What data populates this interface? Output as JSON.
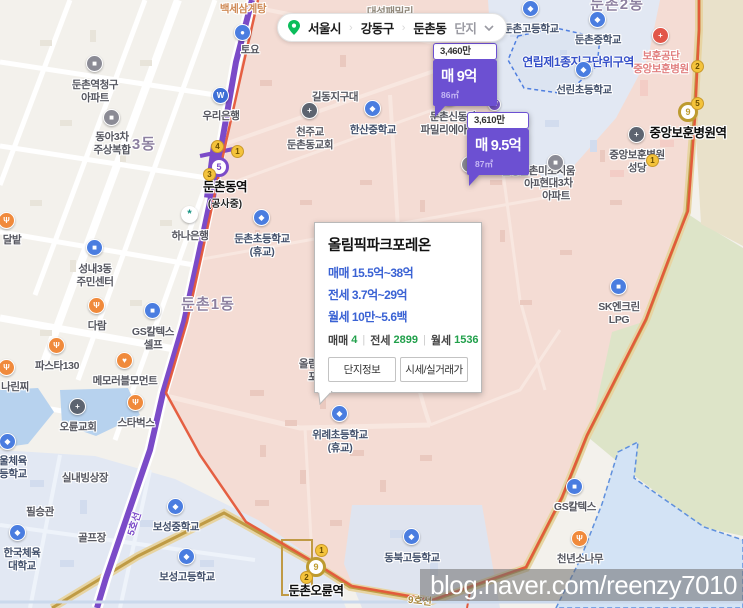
{
  "filter_bar": {
    "region_labels": [
      "서울시",
      "강동구",
      "둔촌동"
    ],
    "dropdown_label": "단지",
    "separator": "›",
    "pin_color": "#0bbd5b"
  },
  "markers": [
    {
      "sub_price": "3,460만",
      "price": "매 9억",
      "area": "86㎡"
    },
    {
      "sub_price": "3,610만",
      "price": "매 9.5억",
      "area": "87㎡"
    }
  ],
  "complex_card": {
    "title": "올림픽파크포레온",
    "sale": "매매 15.5억~38억",
    "jeonse": "전세 3.7억~29억",
    "wolse": "월세 10만~5.6백",
    "counts": [
      {
        "label": "매매",
        "value": "4"
      },
      {
        "label": "전세",
        "value": "2899"
      },
      {
        "label": "월세",
        "value": "1536"
      }
    ],
    "counts_sep": "|",
    "buttons": [
      "단지정보",
      "시세/실거래가"
    ]
  },
  "watermark": "blog.naver.com/reenzy7010",
  "colors": {
    "marker_purple": "#6c50d2",
    "line5_purple": "#7b4bc8",
    "line9_gold": "#bf9b45",
    "boundary_red": "#e4573a",
    "price_blue": "#3a62d4",
    "count_green": "#21a04b"
  },
  "map": {
    "districts": [
      {
        "label": "둔촌1동",
        "x": 208,
        "y": 293
      },
      {
        "label": "3동",
        "x": 144,
        "y": 133
      },
      {
        "label": "둔촌2동",
        "x": 617,
        "y": -7
      }
    ],
    "zone_label": {
      "label": "연립제1종지구단위구역",
      "x": 578,
      "y": 53
    },
    "line_labels": [
      {
        "label": "5호선",
        "x": 121,
        "y": 516,
        "rot": -72,
        "color": "#7b4bc8"
      },
      {
        "label": "9호선",
        "x": 408,
        "y": 592,
        "rot": 6,
        "color": "#a8863a"
      }
    ],
    "stations": [
      {
        "name": "둔촌동역",
        "sub": "(공사중)",
        "x": 225,
        "y": 176,
        "badge": "5",
        "badge_color": "#7b4bc8",
        "bx": 219,
        "by": 167,
        "exits": [
          {
            "n": "4",
            "x": 217,
            "y": 146
          },
          {
            "n": "1",
            "x": 237,
            "y": 151
          },
          {
            "n": "3",
            "x": 209,
            "y": 174
          }
        ]
      },
      {
        "name": "둔촌오륜역",
        "sub": "",
        "x": 316,
        "y": 580,
        "badge": "9",
        "badge_color": "#bd9b30",
        "bx": 316,
        "by": 567,
        "exits": [
          {
            "n": "1",
            "x": 321,
            "y": 550
          },
          {
            "n": "2",
            "x": 306,
            "y": 577
          }
        ]
      },
      {
        "name": "중앙보훈병원역",
        "sub": "",
        "x": 688,
        "y": 122,
        "badge": "9",
        "badge_color": "#bd9b30",
        "bx": 688,
        "by": 112,
        "exits": [
          {
            "n": "2",
            "x": 697,
            "y": 66
          },
          {
            "n": "5",
            "x": 697,
            "y": 103
          },
          {
            "n": "1",
            "x": 652,
            "y": 160
          }
        ]
      }
    ],
    "pois": [
      {
        "lines": [
          "백세삼계탕"
        ],
        "x": 243,
        "y": 3,
        "cls": "orange-text"
      },
      {
        "lines": [
          "대성패밀리"
        ],
        "x": 390,
        "y": 6,
        "cls": "brown"
      },
      {
        "lines": [
          "토요"
        ],
        "x": 250,
        "y": 44,
        "icon": "store",
        "icx": 243,
        "icy": 33
      },
      {
        "lines": [
          "둔촌역청구",
          "아파트"
        ],
        "x": 95,
        "y": 79,
        "icon": "building",
        "icx": 95,
        "icy": 64
      },
      {
        "lines": [
          "우리은행"
        ],
        "x": 221,
        "y": 110,
        "icon": "bank-woori",
        "icx": 221,
        "icy": 96
      },
      {
        "lines": [
          "동아3차",
          "주상복합"
        ],
        "x": 112,
        "y": 131,
        "icon": "building",
        "icx": 112,
        "icy": 118
      },
      {
        "lines": [
          "하나은행"
        ],
        "x": 190,
        "y": 230,
        "icon": "bank-hana",
        "icx": 190,
        "icy": 215
      },
      {
        "lines": [
          "성내3동",
          "주민센터"
        ],
        "x": 95,
        "y": 263,
        "icon": "office",
        "icx": 95,
        "icy": 248
      },
      {
        "lines": [
          "다람"
        ],
        "x": 97,
        "y": 320,
        "icon": "food",
        "icx": 97,
        "icy": 306
      },
      {
        "lines": [
          "GS칼텍스",
          "셀프"
        ],
        "x": 153,
        "y": 326,
        "icon": "gas",
        "icx": 153,
        "icy": 311
      },
      {
        "lines": [
          "파스타130"
        ],
        "x": 57,
        "y": 360,
        "icon": "food",
        "icx": 57,
        "icy": 346
      },
      {
        "lines": [
          "메모러블모먼트"
        ],
        "x": 125,
        "y": 375,
        "icon": "heart",
        "icx": 125,
        "icy": 361
      },
      {
        "lines": [
          "달밭"
        ],
        "x": 12,
        "y": 234,
        "icon": "food",
        "icx": 7,
        "icy": 221
      },
      {
        "lines": [
          "나린찌"
        ],
        "x": 15,
        "y": 381,
        "icon": "food",
        "icx": 7,
        "icy": 368
      },
      {
        "lines": [
          "오륜교회"
        ],
        "x": 78,
        "y": 421,
        "icon": "church",
        "icx": 78,
        "icy": 407
      },
      {
        "lines": [
          "스타벅스"
        ],
        "x": 136,
        "y": 417,
        "icon": "cafe",
        "icx": 136,
        "icy": 403
      },
      {
        "lines": [
          "울체육",
          "등학교"
        ],
        "x": 13,
        "y": 455,
        "icon": "school",
        "icx": 8,
        "icy": 442,
        "cls": "navy"
      },
      {
        "lines": [
          "실내빙상장"
        ],
        "x": 85,
        "y": 472
      },
      {
        "lines": [
          "필승관"
        ],
        "x": 40,
        "y": 506
      },
      {
        "lines": [
          "골프장"
        ],
        "x": 92,
        "y": 532
      },
      {
        "lines": [
          "한국체육",
          "대학교"
        ],
        "x": 22,
        "y": 547,
        "icon": "school",
        "icx": 18,
        "icy": 533,
        "cls": "navy"
      },
      {
        "lines": [
          "보성중학교"
        ],
        "x": 176,
        "y": 521,
        "icon": "school",
        "icx": 176,
        "icy": 507,
        "cls": "navy"
      },
      {
        "lines": [
          "보성고등학교"
        ],
        "x": 187,
        "y": 571,
        "icon": "school",
        "icx": 187,
        "icy": 557,
        "cls": "navy"
      },
      {
        "lines": [
          "동북고등학교"
        ],
        "x": 412,
        "y": 552,
        "icon": "school",
        "icx": 412,
        "icy": 537,
        "cls": "navy"
      },
      {
        "lines": [
          "천주교",
          "둔촌동교회"
        ],
        "x": 310,
        "y": 126,
        "icon": "church",
        "icx": 310,
        "icy": 111
      },
      {
        "lines": [
          "한산중학교"
        ],
        "x": 373,
        "y": 124,
        "icon": "school",
        "icx": 373,
        "icy": 109,
        "cls": "navy"
      },
      {
        "lines": [
          "길동지구대"
        ],
        "x": 335,
        "y": 91
      },
      {
        "lines": [
          "둔촌신동아",
          "파밀리에아파트"
        ],
        "x": 453,
        "y": 111,
        "icon": "building",
        "icx": 450,
        "icy": 98
      },
      {
        "lines": [],
        "icon": "building",
        "icx": 470,
        "icy": 165
      },
      {
        "lines": [
          "신성둔촌미소지움",
          "아파트"
        ],
        "x": 538,
        "y": 165
      },
      {
        "lines": [
          "현대3차",
          "아파트"
        ],
        "x": 556,
        "y": 177,
        "icon": "building",
        "icx": 556,
        "icy": 163
      },
      {
        "lines": [
          "둔촌고등학교"
        ],
        "x": 531,
        "y": 23,
        "icon": "school",
        "icx": 531,
        "icy": 9,
        "cls": "navy"
      },
      {
        "lines": [
          "둔촌중학교"
        ],
        "x": 598,
        "y": 34,
        "icon": "school",
        "icx": 598,
        "icy": 20,
        "cls": "navy"
      },
      {
        "lines": [
          "선린초등학교"
        ],
        "x": 584,
        "y": 84,
        "icon": "school",
        "icx": 584,
        "icy": 70,
        "cls": "navy"
      },
      {
        "lines": [
          "보훈공단",
          "중앙보훈병원"
        ],
        "x": 661,
        "y": 50,
        "icon": "hospital",
        "icx": 661,
        "icy": 36,
        "cls": "red-text"
      },
      {
        "lines": [
          "중앙보훈병원",
          "성당"
        ],
        "x": 637,
        "y": 149,
        "icon": "church",
        "icx": 637,
        "icy": 135
      },
      {
        "lines": [
          "SK엔크린",
          "LPG"
        ],
        "x": 619,
        "y": 301,
        "icon": "gas",
        "icx": 619,
        "icy": 287
      },
      {
        "lines": [
          "GS칼텍스"
        ],
        "x": 575,
        "y": 501,
        "icon": "gas",
        "icx": 575,
        "icy": 487
      },
      {
        "lines": [
          "천년소나무"
        ],
        "x": 580,
        "y": 553,
        "icon": "food",
        "icx": 580,
        "icy": 539
      },
      {
        "lines": [
          "위례초등학교",
          "(휴교)"
        ],
        "x": 340,
        "y": 429,
        "icon": "school",
        "icx": 340,
        "icy": 414,
        "cls": "navy"
      },
      {
        "lines": [
          "둔촌초등학교",
          "(휴교)"
        ],
        "x": 262,
        "y": 233,
        "icon": "school",
        "icx": 262,
        "icy": 218,
        "cls": "navy"
      },
      {
        "lines": [
          "올림픽파크",
          "포레온"
        ],
        "x": 322,
        "y": 358
      },
      {
        "lines": [],
        "icon": "subway-logo",
        "icx": 497,
        "icy": 107
      }
    ]
  }
}
